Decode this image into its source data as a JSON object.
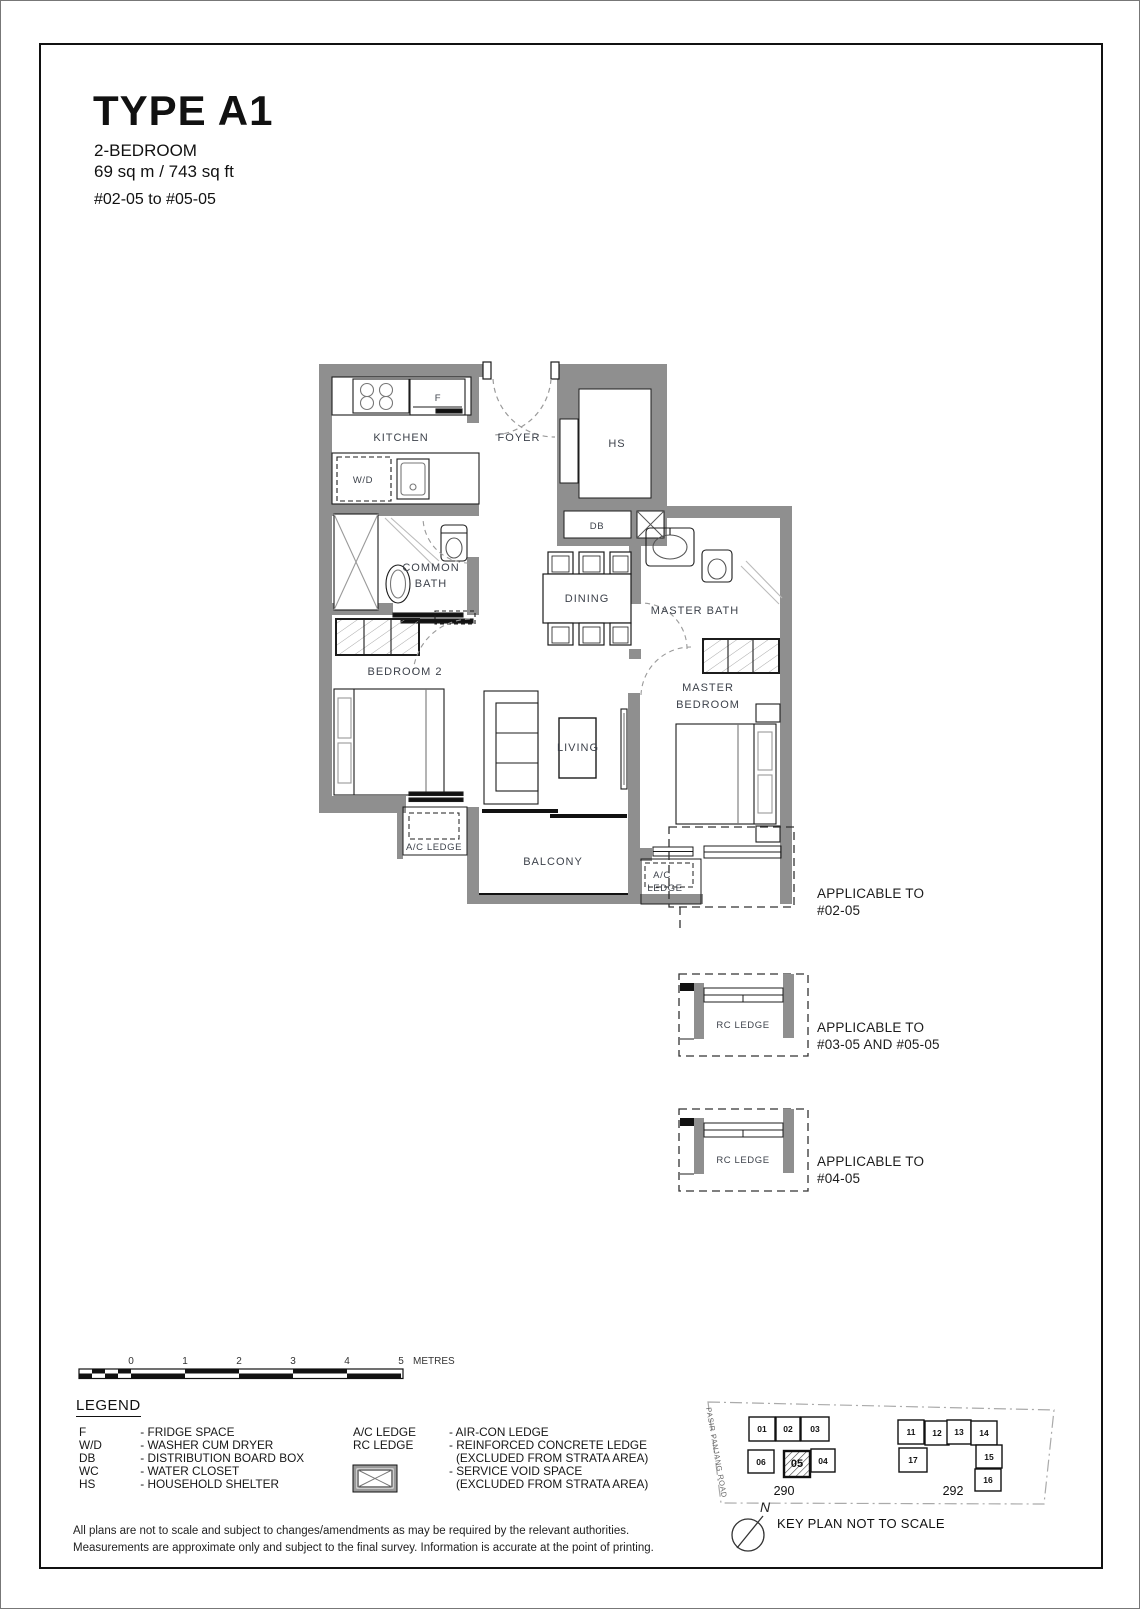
{
  "page": {
    "title": "TYPE A1",
    "subtitle_line1": "2-BEDROOM",
    "subtitle_line2": "69 sq m / 743 sq ft",
    "unit_range": "#02-05 to #05-05"
  },
  "floorplan": {
    "labels": {
      "kitchen": "KITCHEN",
      "foyer": "FOYER",
      "hs": "HS",
      "f": "F",
      "wd": "W/D",
      "db": "DB",
      "common_bath_line1": "COMMON",
      "common_bath_line2": "BATH",
      "dining": "DINING",
      "master_bath": "MASTER BATH",
      "bedroom2": "BEDROOM 2",
      "living": "LIVING",
      "master_bedroom_line1": "MASTER",
      "master_bedroom_line2": "BEDROOM",
      "balcony": "BALCONY",
      "ac_ledge_left": "A/C LEDGE",
      "ac_ledge_right_line1": "A/C",
      "ac_ledge_right_line2": "LEDGE"
    }
  },
  "annotations": {
    "a1_line1": "APPLICABLE TO",
    "a1_line2": "#02-05",
    "a2_label": "RC LEDGE",
    "a2_line1": "APPLICABLE TO",
    "a2_line2": "#03-05 AND #05-05",
    "a3_label": "RC LEDGE",
    "a3_line1": "APPLICABLE TO",
    "a3_line2": "#04-05"
  },
  "scalebar": {
    "ticks": [
      "0",
      "1",
      "2",
      "3",
      "4",
      "5"
    ],
    "unit": "METRES"
  },
  "legend": {
    "title": "LEGEND",
    "left": [
      {
        "abbr": "F",
        "def": "- FRIDGE SPACE"
      },
      {
        "abbr": "W/D",
        "def": "- WASHER CUM DRYER"
      },
      {
        "abbr": "DB",
        "def": "- DISTRIBUTION BOARD BOX"
      },
      {
        "abbr": "WC",
        "def": "- WATER CLOSET"
      },
      {
        "abbr": "HS",
        "def": "- HOUSEHOLD SHELTER"
      }
    ],
    "right": {
      "ac_abbr": "A/C LEDGE",
      "ac_def": "- AIR-CON LEDGE",
      "rc_abbr": "RC LEDGE",
      "rc_def": "- REINFORCED CONCRETE LEDGE",
      "rc_def2": "(EXCLUDED FROM STRATA AREA)",
      "void_def": "- SERVICE VOID SPACE",
      "void_def2": "(EXCLUDED FROM STRATA AREA)"
    }
  },
  "keyplan": {
    "road": "PASIR PANJANG ROAD",
    "block_left": "290",
    "block_right": "292",
    "units_left": [
      "01",
      "02",
      "03",
      "06",
      "05",
      "04"
    ],
    "units_right": [
      "11",
      "12",
      "13",
      "14",
      "17",
      "15",
      "16"
    ],
    "highlighted_unit": "05",
    "north": "N",
    "caption": "KEY PLAN NOT TO SCALE"
  },
  "disclaimer": {
    "line1": "All plans are not to scale and subject to changes/amendments as may be required by the relevant authorities.",
    "line2": "Measurements are approximate only and subject to the final survey. Information is accurate at the point of printing."
  },
  "colors": {
    "wall": "#8f8f8f",
    "line": "#1c1c1c",
    "label": "#3d424b"
  }
}
